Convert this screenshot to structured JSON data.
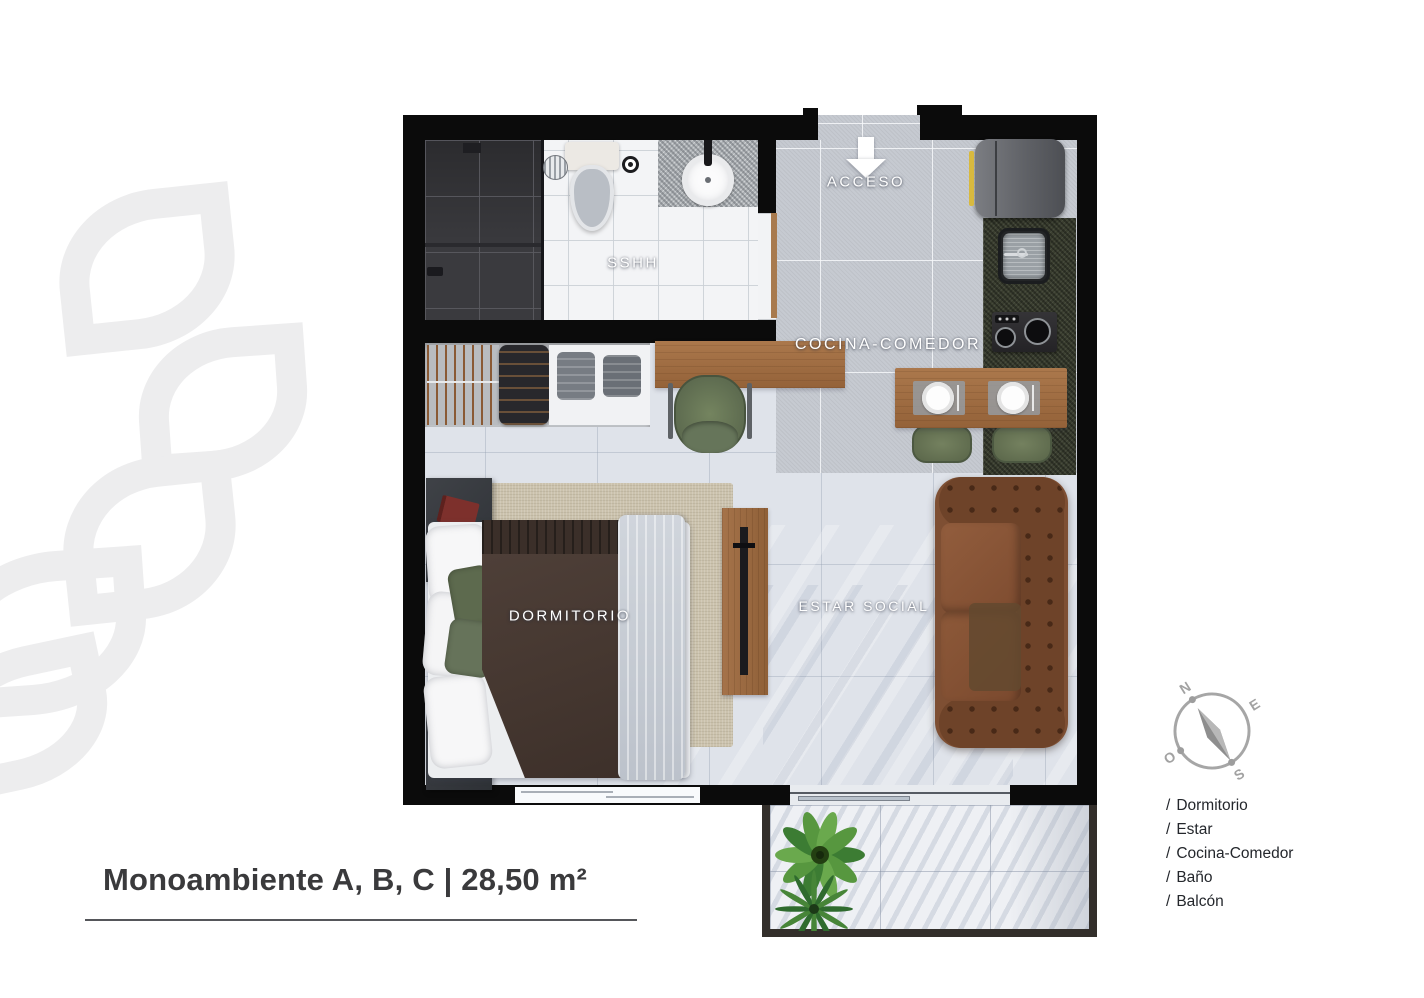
{
  "title": {
    "text": "Monoambiente A, B, C | 28,50 m²"
  },
  "plan": {
    "labels": {
      "acceso": "ACCESO",
      "sshh": "SSHH",
      "cocina_comedor": "COCINA-COMEDOR",
      "dormitorio": "DORMITORIO",
      "estar_social": "ESTAR SOCIAL"
    }
  },
  "legend": {
    "prefix": "/",
    "items": [
      "Dormitorio",
      "Estar",
      "Cocina-Comedor",
      "Baño",
      "Balcón"
    ]
  },
  "compass": {
    "north": "N",
    "east": "E",
    "south": "S",
    "west": "O"
  },
  "colors": {
    "wall": "#0b0b0b",
    "wood": "#a5734a",
    "sofa_leather": "#84523a",
    "chair_green": "#6b7a5e",
    "counter_dark": "#3a3e2f",
    "watermark": "#EDEDEE",
    "title_text": "#3a3a3c"
  }
}
